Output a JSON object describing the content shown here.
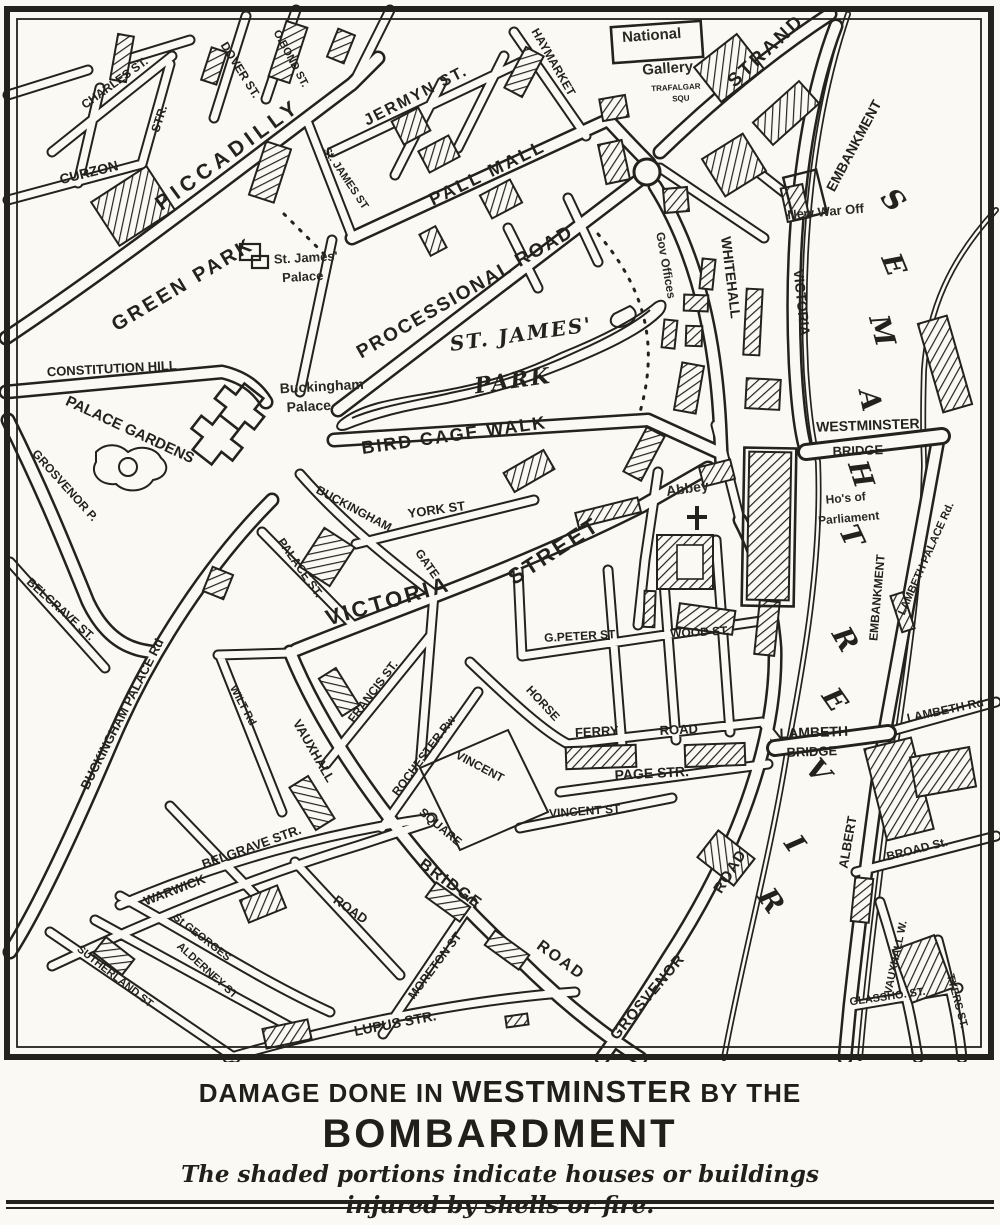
{
  "colors": {
    "ink": "#23221c",
    "paper": "#faf9f3"
  },
  "caption": {
    "line1_prefix": "DAMAGE DONE IN ",
    "line1_emphasis": "WESTMINSTER",
    "line1_suffix": " BY THE",
    "line2": "BOMBARDMENT",
    "line3": "The shaded portions indicate houses or buildings",
    "line4": "injured by shells or fire."
  },
  "map": {
    "labels": [
      {
        "t": "CHARLES ST.",
        "x": 117,
        "y": 86,
        "r": -36,
        "s": 12
      },
      {
        "t": "STR.",
        "x": 163,
        "y": 120,
        "r": -72,
        "s": 12
      },
      {
        "t": "CURZON",
        "x": 90,
        "y": 177,
        "r": -14,
        "s": 14
      },
      {
        "t": "DOVER ST.",
        "x": 237,
        "y": 72,
        "r": 58,
        "s": 12
      },
      {
        "t": "O.BOND ST.",
        "x": 288,
        "y": 60,
        "r": 62,
        "s": 11
      },
      {
        "t": "PICCADILLY",
        "x": 232,
        "y": 160,
        "r": -36,
        "s": 21,
        "ls": 5
      },
      {
        "t": "JERMYN ST.",
        "x": 418,
        "y": 100,
        "r": -27,
        "s": 16,
        "ls": 2
      },
      {
        "t": "St. JAMES ST",
        "x": 343,
        "y": 180,
        "r": 56,
        "s": 11
      },
      {
        "t": "PALL MALL",
        "x": 490,
        "y": 178,
        "r": -26,
        "s": 18,
        "ls": 3
      },
      {
        "t": "HAYMARKET",
        "x": 550,
        "y": 64,
        "r": 60,
        "s": 12
      },
      {
        "t": "National",
        "x": 652,
        "y": 40,
        "r": -4,
        "s": 15,
        "c": "place"
      },
      {
        "t": "Gallery",
        "x": 668,
        "y": 73,
        "r": -4,
        "s": 15,
        "c": "place"
      },
      {
        "t": "TRAFALGAR",
        "x": 676,
        "y": 90,
        "r": -3,
        "s": 8
      },
      {
        "t": "SQU",
        "x": 681,
        "y": 101,
        "r": -3,
        "s": 8
      },
      {
        "t": "STRAND",
        "x": 770,
        "y": 55,
        "r": -43,
        "s": 19,
        "ls": 3
      },
      {
        "t": "New War Off",
        "x": 826,
        "y": 216,
        "r": -5,
        "s": 13,
        "c": "place"
      },
      {
        "t": "WHITEHALL",
        "x": 726,
        "y": 278,
        "r": 83,
        "s": 14
      },
      {
        "t": "Gov Offices",
        "x": 662,
        "y": 266,
        "r": 80,
        "s": 12,
        "c": "place"
      },
      {
        "t": "VICTORIA",
        "x": 797,
        "y": 303,
        "r": 84,
        "s": 14
      },
      {
        "t": "EMBANKMENT",
        "x": 858,
        "y": 148,
        "r": -62,
        "s": 14
      },
      {
        "t": "GREEN PARK",
        "x": 186,
        "y": 290,
        "r": -31,
        "s": 20,
        "ls": 3
      },
      {
        "t": "St. James'",
        "x": 306,
        "y": 262,
        "r": -3,
        "s": 13,
        "c": "place"
      },
      {
        "t": "Palace",
        "x": 303,
        "y": 281,
        "r": -3,
        "s": 13,
        "c": "place"
      },
      {
        "t": "PROCESSIONAL ROAD",
        "x": 468,
        "y": 297,
        "r": -30,
        "s": 19,
        "ls": 2
      },
      {
        "t": "ST. JAMES'",
        "x": 522,
        "y": 341,
        "r": -8,
        "s": 20,
        "c": "park"
      },
      {
        "t": "PARK",
        "x": 514,
        "y": 388,
        "r": -8,
        "s": 22,
        "c": "park"
      },
      {
        "t": "CONSTITUTION HILL",
        "x": 112,
        "y": 373,
        "r": -3,
        "s": 13
      },
      {
        "t": "PALACE GARDENS",
        "x": 128,
        "y": 434,
        "r": 25,
        "s": 15
      },
      {
        "t": "GROSVENOR P.",
        "x": 62,
        "y": 488,
        "r": 48,
        "s": 12
      },
      {
        "t": "Buckingham",
        "x": 322,
        "y": 391,
        "r": -3,
        "s": 14,
        "c": "place"
      },
      {
        "t": "Palace",
        "x": 309,
        "y": 411,
        "r": -3,
        "s": 14,
        "c": "place"
      },
      {
        "t": "BIRD CAGE WALK",
        "x": 455,
        "y": 441,
        "r": -8,
        "s": 18,
        "ls": 2
      },
      {
        "t": "BUCKINGHAM",
        "x": 352,
        "y": 512,
        "r": 28,
        "s": 12
      },
      {
        "t": "GATE",
        "x": 424,
        "y": 566,
        "r": 55,
        "s": 12
      },
      {
        "t": "YORK ST",
        "x": 437,
        "y": 514,
        "r": -8,
        "s": 13
      },
      {
        "t": "PALACE ST.",
        "x": 297,
        "y": 570,
        "r": 55,
        "s": 12
      },
      {
        "t": "VICTORIA",
        "x": 390,
        "y": 608,
        "r": -16,
        "s": 22,
        "ls": 3
      },
      {
        "t": "STREET",
        "x": 558,
        "y": 557,
        "r": -33,
        "s": 22,
        "ls": 3
      },
      {
        "t": "WESTMINSTER",
        "x": 868,
        "y": 430,
        "r": -2,
        "s": 14
      },
      {
        "t": "BRIDGE",
        "x": 858,
        "y": 455,
        "r": -2,
        "s": 13
      },
      {
        "t": "Abbey",
        "x": 688,
        "y": 493,
        "r": -8,
        "s": 14,
        "c": "place"
      },
      {
        "t": "Ho's of",
        "x": 846,
        "y": 502,
        "r": -5,
        "s": 12,
        "c": "place"
      },
      {
        "t": "Parliament",
        "x": 849,
        "y": 522,
        "r": -5,
        "s": 12,
        "c": "place"
      },
      {
        "t": "LAMBETH PALACE Rd.",
        "x": 929,
        "y": 560,
        "r": -66,
        "s": 11
      },
      {
        "t": "WOOD ST.",
        "x": 700,
        "y": 636,
        "r": -3,
        "s": 12
      },
      {
        "t": "G.PETER ST",
        "x": 580,
        "y": 640,
        "r": -3,
        "s": 12
      },
      {
        "t": "HORSE",
        "x": 540,
        "y": 706,
        "r": 47,
        "s": 12
      },
      {
        "t": "FERRY",
        "x": 597,
        "y": 736,
        "r": -3,
        "s": 13
      },
      {
        "t": "ROAD",
        "x": 679,
        "y": 734,
        "r": -3,
        "s": 13
      },
      {
        "t": "PAGE STR.",
        "x": 652,
        "y": 778,
        "r": -3,
        "s": 14
      },
      {
        "t": "VINCENT ST",
        "x": 585,
        "y": 815,
        "r": -4,
        "s": 12
      },
      {
        "t": "FRANCIS ST.",
        "x": 376,
        "y": 694,
        "r": -53,
        "s": 12
      },
      {
        "t": "ROCHESTER Rw",
        "x": 427,
        "y": 758,
        "r": -53,
        "s": 12
      },
      {
        "t": "VINCENT",
        "x": 478,
        "y": 770,
        "r": 28,
        "s": 12
      },
      {
        "t": "SQUARE",
        "x": 438,
        "y": 830,
        "r": 40,
        "s": 12
      },
      {
        "t": "WILT Rd",
        "x": 240,
        "y": 707,
        "r": 62,
        "s": 11
      },
      {
        "t": "VAUXHALL",
        "x": 310,
        "y": 753,
        "r": 60,
        "s": 13
      },
      {
        "t": "BELGRAVE ST.",
        "x": 58,
        "y": 612,
        "r": 42,
        "s": 12
      },
      {
        "t": "BUCKINGHAM PALACE Rd",
        "x": 126,
        "y": 716,
        "r": -63,
        "s": 13
      },
      {
        "t": "BELGRAVE STR.",
        "x": 253,
        "y": 851,
        "r": -20,
        "s": 13
      },
      {
        "t": "WARWICK",
        "x": 176,
        "y": 894,
        "r": -21,
        "s": 13
      },
      {
        "t": "ROAD",
        "x": 348,
        "y": 913,
        "r": 35,
        "s": 13
      },
      {
        "t": "St GEORGES",
        "x": 200,
        "y": 940,
        "r": 38,
        "s": 11
      },
      {
        "t": "ALDERNEY ST",
        "x": 205,
        "y": 973,
        "r": 42,
        "s": 11
      },
      {
        "t": "SUTHERLAND ST",
        "x": 113,
        "y": 979,
        "r": 38,
        "s": 11
      },
      {
        "t": "LUPUS STR.",
        "x": 396,
        "y": 1028,
        "r": -11,
        "s": 14
      },
      {
        "t": "MORETON ST",
        "x": 438,
        "y": 968,
        "r": -53,
        "s": 12
      },
      {
        "t": "BRIDGE",
        "x": 448,
        "y": 888,
        "r": 36,
        "s": 16,
        "ls": 2
      },
      {
        "t": "ROAD",
        "x": 558,
        "y": 964,
        "r": 36,
        "s": 16,
        "ls": 2
      },
      {
        "t": "GROSVENOR",
        "x": 651,
        "y": 1000,
        "r": -50,
        "s": 15,
        "ls": 1
      },
      {
        "t": "ROAD",
        "x": 734,
        "y": 874,
        "r": -58,
        "s": 15,
        "ls": 1
      },
      {
        "t": "LAMBETH",
        "x": 814,
        "y": 737,
        "r": -2,
        "s": 14
      },
      {
        "t": "BRIDGE",
        "x": 812,
        "y": 756,
        "r": -2,
        "s": 13
      },
      {
        "t": "EMBANKMENT",
        "x": 881,
        "y": 598,
        "r": -85,
        "s": 12
      },
      {
        "t": "ALBERT",
        "x": 852,
        "y": 843,
        "r": -80,
        "s": 13
      },
      {
        "t": "LAMBETH Rd",
        "x": 946,
        "y": 714,
        "r": -12,
        "s": 12
      },
      {
        "t": "BROAD St.",
        "x": 918,
        "y": 853,
        "r": -14,
        "s": 12
      },
      {
        "t": "VAUXHALL W.",
        "x": 899,
        "y": 958,
        "r": -78,
        "s": 11
      },
      {
        "t": "GLASSHO. ST.",
        "x": 888,
        "y": 1000,
        "r": -8,
        "s": 11
      },
      {
        "t": "TYERS ST.",
        "x": 954,
        "y": 1002,
        "r": 75,
        "s": 11
      }
    ],
    "river_word": [
      {
        "t": "R",
        "x": 763,
        "y": 906,
        "r": 55
      },
      {
        "t": "I",
        "x": 787,
        "y": 849,
        "r": 55
      },
      {
        "t": "V",
        "x": 811,
        "y": 777,
        "r": 50
      },
      {
        "t": "E",
        "x": 827,
        "y": 705,
        "r": 55
      },
      {
        "t": "R",
        "x": 837,
        "y": 644,
        "r": 60
      },
      {
        "t": "T",
        "x": 843,
        "y": 540,
        "r": 65
      },
      {
        "t": "H",
        "x": 852,
        "y": 477,
        "r": 72
      },
      {
        "t": "A",
        "x": 861,
        "y": 402,
        "r": 78
      },
      {
        "t": "M",
        "x": 873,
        "y": 333,
        "r": 75
      },
      {
        "t": "E",
        "x": 885,
        "y": 268,
        "r": 68
      },
      {
        "t": "S",
        "x": 886,
        "y": 206,
        "r": 50
      }
    ]
  }
}
